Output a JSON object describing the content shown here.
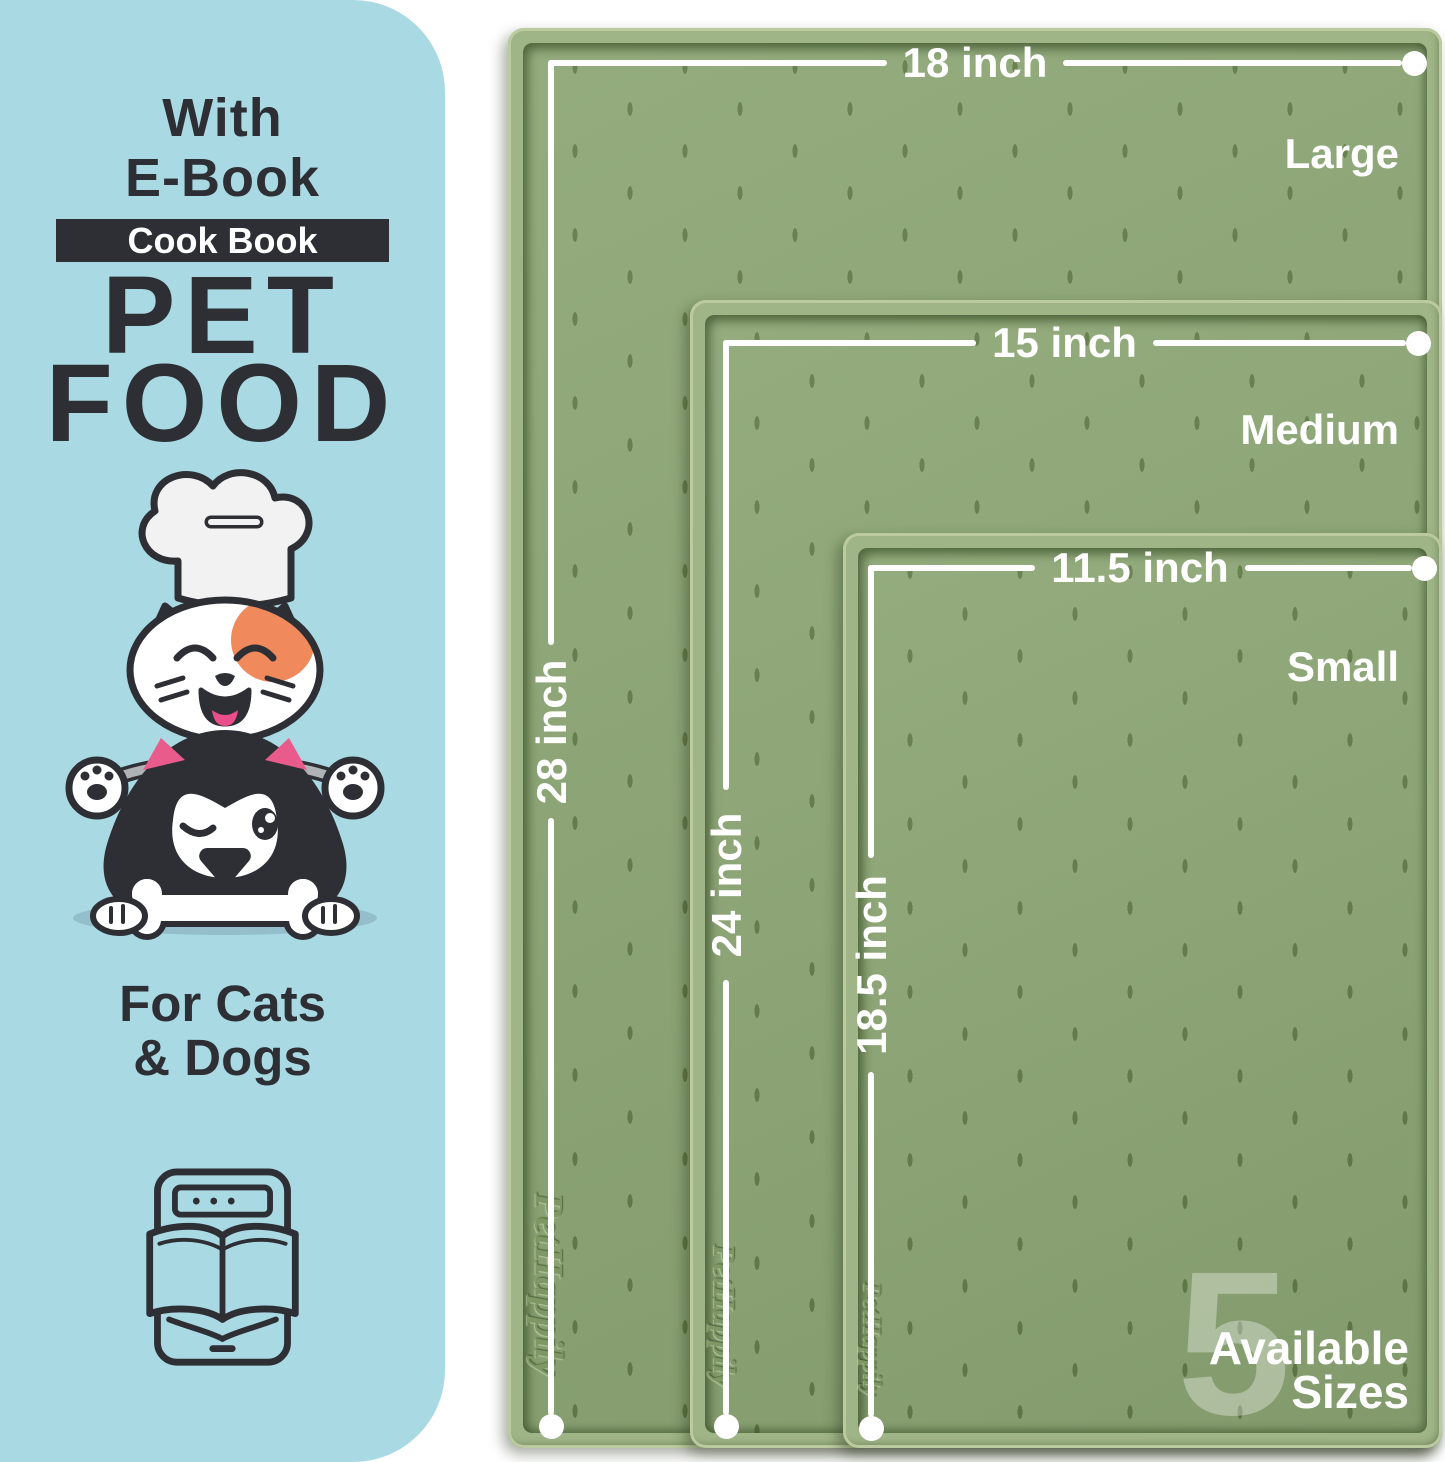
{
  "panel": {
    "line1": "With",
    "line2": "E-Book",
    "badge": "Cook Book",
    "title1": "PET",
    "title2": "FOOD",
    "audience1": "For Cats",
    "audience2": "& Dogs"
  },
  "mats": [
    {
      "size_label": "Large",
      "width_label": "18 inch",
      "height_label": "28 inch",
      "brand": "PetHappily"
    },
    {
      "size_label": "Medium",
      "width_label": "15 inch",
      "height_label": "24 inch",
      "brand": "PetHappily"
    },
    {
      "size_label": "Small",
      "width_label": "11.5 inch",
      "height_label": "18.5 inch",
      "brand": "PetHappily"
    }
  ],
  "sizes_badge": {
    "number": "5",
    "line1": "Available",
    "line2": "Sizes"
  },
  "icons": {
    "illustration": "cat-and-dog-chef-illustration",
    "ebook": "ebook-tablet-icon"
  },
  "colors": {
    "panel_blue": "#a9d9e3",
    "ink": "#2d2f35",
    "mat_surface": "#8ca674",
    "mat_rim": "#a0b587",
    "dimension_white": "#ffffff",
    "patch_orange": "#f08a5c",
    "pink_accent": "#e85b8a"
  }
}
